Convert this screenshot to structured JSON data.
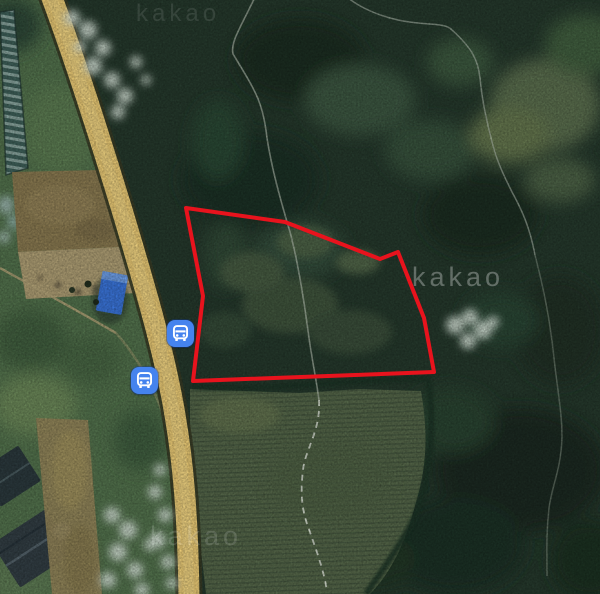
{
  "map": {
    "view_type": "satellite",
    "provider": "kakao",
    "watermark_text": "kakao",
    "watermarks": [
      {
        "left": 412,
        "top": 263,
        "font_size": 27,
        "opacity": 0.3
      },
      {
        "left": 150,
        "top": 522,
        "font_size": 27,
        "opacity": 0.14
      },
      {
        "left": 136,
        "top": 1,
        "font_size": 24,
        "opacity": 0.1
      }
    ],
    "markers": [
      {
        "type": "bus-stop",
        "x": 180,
        "y": 333
      },
      {
        "type": "bus-stop",
        "x": 144,
        "y": 380
      }
    ],
    "parcel_outline": {
      "stroke_color": "#e8131d",
      "stroke_width": 4,
      "points": [
        [
          186,
          208
        ],
        [
          285,
          222
        ],
        [
          380,
          259
        ],
        [
          398,
          252
        ],
        [
          424,
          318
        ],
        [
          434,
          372
        ],
        [
          193,
          381
        ],
        [
          203,
          296
        ]
      ]
    },
    "colors": {
      "marker_blue": "#4583ee",
      "parcel_red": "#e8131d",
      "road_yellow": "#edcd77",
      "road_border": "#3a3d26",
      "forest_green": "#263a2d",
      "field_green": "#57694b",
      "watermark_white": "#ffffff"
    }
  }
}
